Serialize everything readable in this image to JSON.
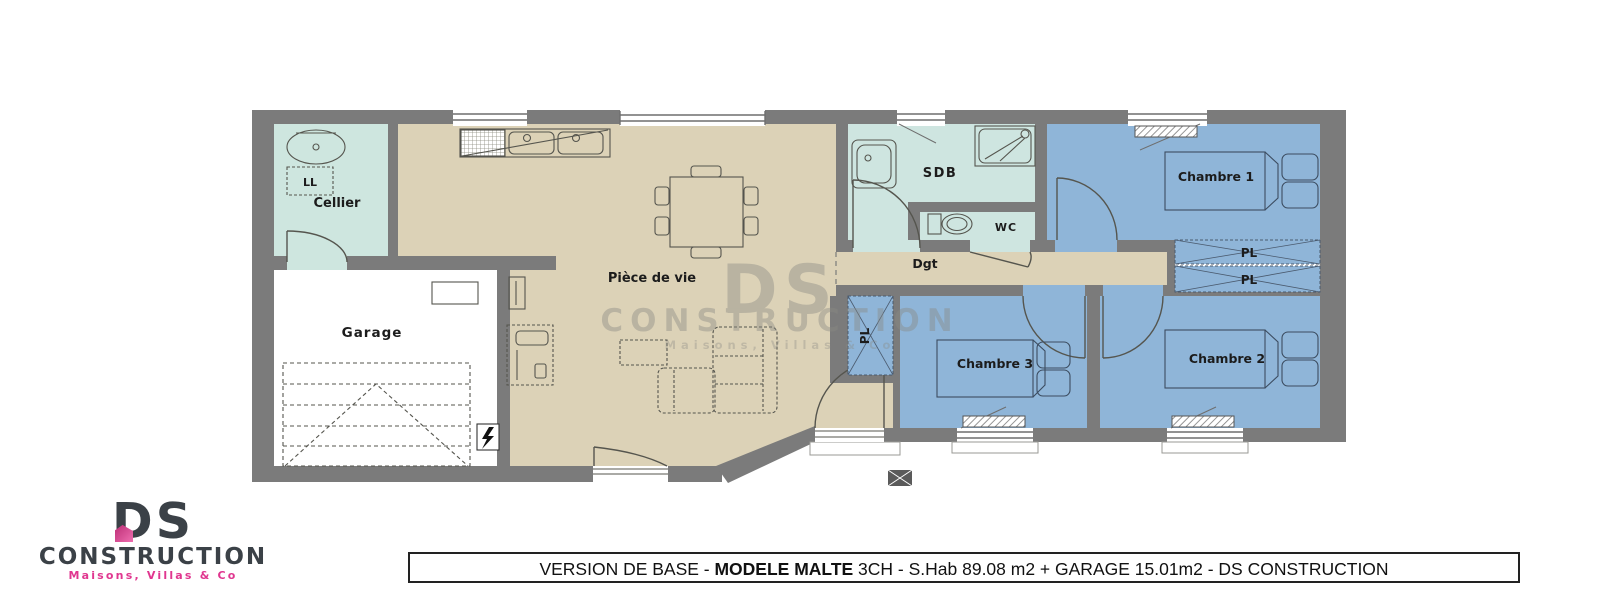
{
  "plan": {
    "rooms": {
      "cellier": "Cellier",
      "garage": "Garage",
      "living": "Pièce de vie",
      "sdb": "SDB",
      "wc": "WC",
      "hall": "Dgt",
      "bedroom1": "Chambre 1",
      "bedroom2": "Chambre 2",
      "bedroom3": "Chambre 3"
    },
    "closet_label": "PL",
    "washer_label": "LL",
    "colors": {
      "wall": "#7b7b7b",
      "living_floor": "#dcd2b7",
      "bedroom_floor": "#8fb5d8",
      "bath_floor": "#cee5e0",
      "cellier_floor": "#cee6df",
      "garage_floor": "#ffffff",
      "outline": "#55554e"
    }
  },
  "watermark": {
    "line1": "DS",
    "line2": "CONSTRUCTION",
    "line3": "Maisons,  Villas  &  Co"
  },
  "logo": {
    "monogram": "DS",
    "name": "CONSTRUCTION",
    "tagline": "Maisons, Villas & Co",
    "accent": "#e0368f",
    "dark": "#3b4147"
  },
  "banner": {
    "prefix": "VERSION DE BASE - ",
    "model": "MODELE MALTE",
    "suffix": " 3CH - S.Hab 89.08 m2 + GARAGE 15.01m2 - DS CONSTRUCTION"
  }
}
